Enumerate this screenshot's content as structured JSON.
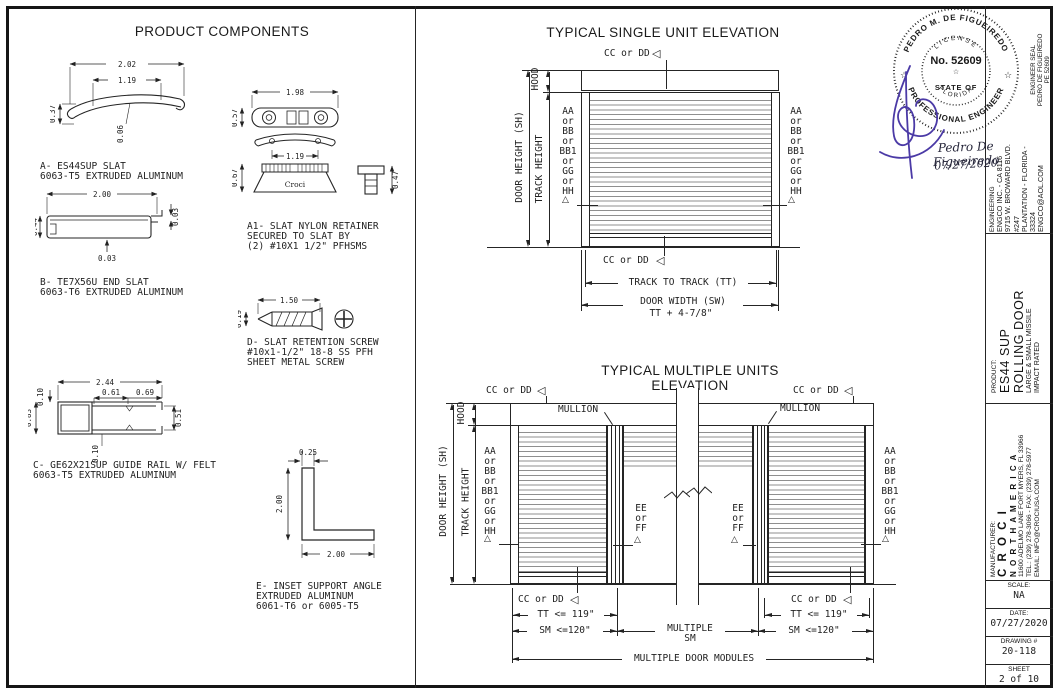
{
  "sheet": {
    "components_title": "PRODUCT COMPONENTS",
    "single_title": "TYPICAL SINGLE UNIT ELEVATION",
    "multiple_title": "TYPICAL MULTIPLE UNITS ELEVATION"
  },
  "components": {
    "a": {
      "caption": "A- ES44SUP SLAT\n6063-T5 EXTRUDED ALUMINUM",
      "dim_width": "2.02",
      "dim_inner": "1.19",
      "dim_height": "0.37",
      "dim_wall": "0.06"
    },
    "b": {
      "caption": "B- TE7X56U END SLAT\n6063-T6 EXTRUDED ALUMINUM",
      "dim_width": "2.00",
      "dim_height": "0.44",
      "dim_wall_right": "0.03",
      "dim_wall_bottom": "0.03"
    },
    "c": {
      "caption": "C- GE62X21SUP GUIDE RAIL W/ FELT\n6063-T5 EXTRUDED ALUMINUM",
      "dim_width": "2.44",
      "dim_slot1": "0.61",
      "dim_slot2": "0.69",
      "dim_wall_top": "0.10",
      "dim_height": "0.83",
      "dim_wall_bottom": "0.10",
      "dim_opening": "0.51"
    },
    "a1": {
      "caption": "A1- SLAT NYLON RETAINER\nSECURED TO SLAT BY\n(2) #10X1 1/2\" PFHSMS",
      "dim_width": "1.98",
      "dim_height_top": "0.57",
      "dim_inner": "1.19",
      "dim_height_base": "0.67",
      "dim_height_screw": "0.47",
      "brand": "Croci"
    },
    "d": {
      "caption": "D- SLAT RETENTION SCREW\n#10x1-1/2\" 18-8 SS PFH\nSHEET METAL SCREW",
      "dim_length": "1.50",
      "dim_dia": "0.19"
    },
    "e": {
      "caption": "E- INSET SUPPORT ANGLE\nEXTRUDED ALUMINUM\n6061-T6 or 6005-T5",
      "dim_thick": "0.25",
      "dim_vert": "2.00",
      "dim_horiz": "2.00"
    }
  },
  "single": {
    "cc": "CC or DD",
    "hood": "HOOD",
    "door_height": "DOOR HEIGHT (SH)",
    "track_height": "TRACK HEIGHT",
    "side_labels": "AA\nor\nBB\nor\nBB1\nor\nGG\nor\nHH",
    "track_to_track": "TRACK TO TRACK (TT)",
    "door_width": "DOOR WIDTH (SW)",
    "door_width2": "TT + 4-7/8\""
  },
  "multiple": {
    "cc": "CC or DD",
    "mullion": "MULLION",
    "hood": "HOOD",
    "door_height": "DOOR HEIGHT (SH)",
    "track_height": "TRACK HEIGHT",
    "side_labels": "AA\nor\nBB\nor\nBB1\nor\nGG\nor\nHH",
    "ee_labels": "EE\nor\nFF",
    "tt_max": "TT <= 119\"",
    "sm_max": "SM <=120\"",
    "multiple_sm": "MULTIPLE\nSM",
    "modules": "MULTIPLE DOOR MODULES"
  },
  "seal": {
    "name_arc": "PEDRO M. DE FIGUEIREDO",
    "license": "LICENSE",
    "number": "No. 52609",
    "state_of": "STATE OF",
    "florida": "FLORIDA",
    "profession_arc": "PROFESSIONAL ENGINEER",
    "star": "☆",
    "signature_name": "Pedro De Figueiredo",
    "signature_date": "07/27/2020"
  },
  "titleblock": {
    "engineer_seal": "ENGINEER SEAL\nPEDRO DE FIGUEIREDO\nPE 52609",
    "engineering_label": "ENGINEERING",
    "engineering_lines": "ENGCO INC. - CA 8116\n9715 W. BROWARD BLVD. #247\nPLANTATION - FLORIDA - 33324\nENGCO@AOL.COM",
    "product_label": "PRODUCT:",
    "product_line1": "ES44 SUP",
    "product_line2": "ROLLING DOOR",
    "product_line3": "LARGE & SMALL MISSILE\nIMPACT RATED",
    "manufacturer_label": "MANUFACTURER:",
    "manufacturer_line1": "C R O C I",
    "manufacturer_line2": "N O R T H  A M E R I C A",
    "manufacturer_line3": "11600 ADELMO LANE FORT MYERS, FL 33966\nTEL.: (239) 278-3066 - FAX: (239) 278-5977\nEMAIL: INFO@CROCIUSA.COM",
    "scale_label": "SCALE:",
    "scale_value": "NA",
    "date_label": "DATE:",
    "date_value": "07/27/2020",
    "drawing_label": "DRAWING #",
    "drawing_value": "20-118",
    "sheet_label": "SHEET",
    "sheet_value": "2 of 10"
  },
  "symbols": {
    "flag": "◁",
    "marker": "△"
  },
  "colors": {
    "line": "#252525",
    "slat": "#8f8f8f",
    "signature": "#4b3aa6"
  }
}
